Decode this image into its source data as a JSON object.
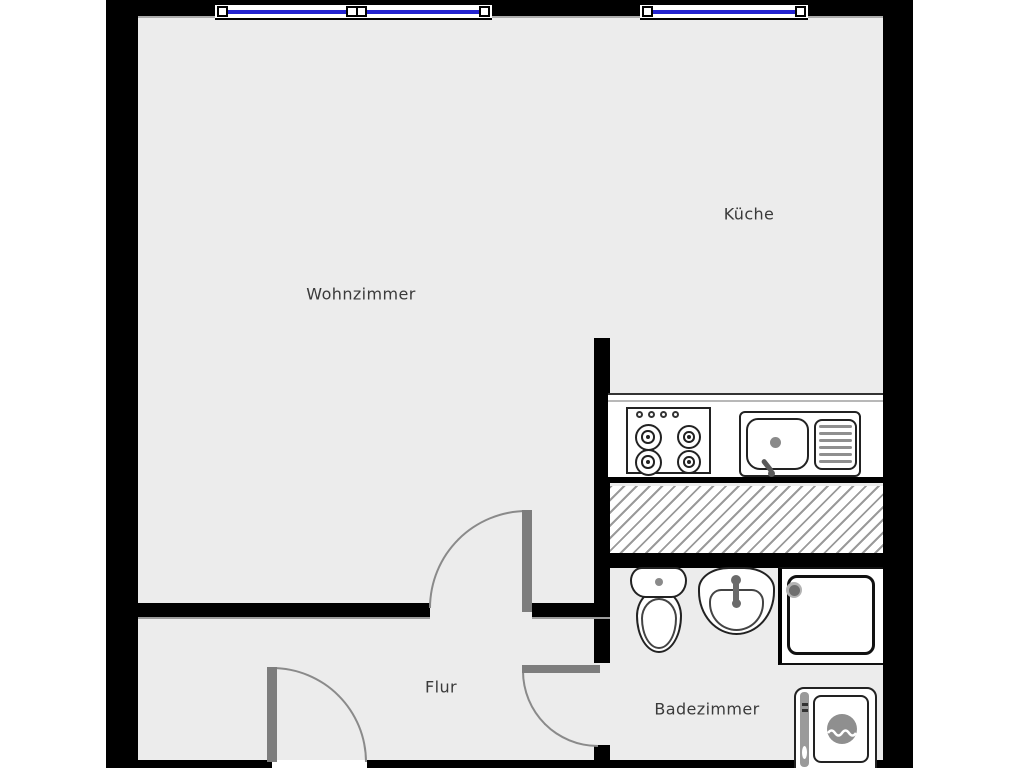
{
  "plan": {
    "type": "apartment-floor-plan",
    "language": "de",
    "rooms": {
      "wohnzimmer": {
        "label": "Wohnzimmer"
      },
      "kueche": {
        "label": "Küche"
      },
      "flur": {
        "label": "Flur"
      },
      "badezimmer": {
        "label": "Badezimmer"
      }
    },
    "features": {
      "windows": [
        "north-window-living-room",
        "north-window-kitchen"
      ],
      "doors": [
        "living-room-to-flur",
        "flur-to-badezimmer",
        "entrance-south"
      ],
      "kitchen_fixtures": [
        "counter",
        "stove-4-burners",
        "sink-with-drainboard",
        "hatched-shaft"
      ],
      "bathroom_fixtures": [
        "toilet",
        "washbasin",
        "shower",
        "washing-machine"
      ]
    },
    "colors": {
      "background": "#ffffff",
      "floor": "#ececec",
      "wall": "#000000",
      "door_leaf": "#7d7d7d",
      "swing_arc": "#8a8a8a",
      "window_glass": "#2323d0",
      "hatch_stripe": "#9a9a9a",
      "fixture_outline": "#222222",
      "label_text": "#3a3a3a"
    }
  }
}
